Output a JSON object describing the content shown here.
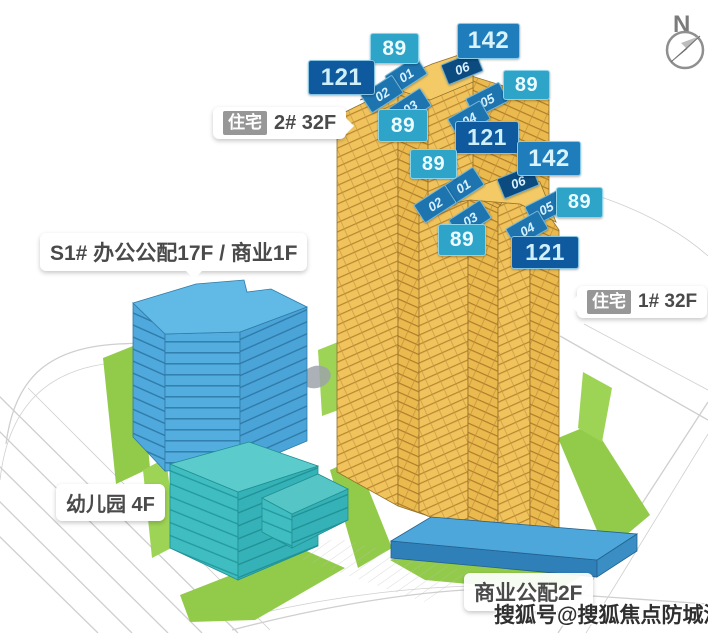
{
  "compass": {
    "label": "N"
  },
  "watermark": {
    "text": "搜狐号@搜狐焦点防城港站"
  },
  "callouts": {
    "residential_2": {
      "tag": "住宅",
      "label": "2# 32F"
    },
    "residential_1": {
      "tag": "住宅",
      "label": "1# 32F"
    },
    "office": {
      "label": "S1# 办公公配17F / 商业1F"
    },
    "kindergarten": {
      "label": "幼儿园 4F"
    },
    "commercial": {
      "label": "商业公配2F"
    }
  },
  "unit_badges": [
    {
      "value": "89",
      "variant": "light",
      "tower": "2#"
    },
    {
      "value": "142",
      "variant": "mid",
      "tower": "2#"
    },
    {
      "value": "121",
      "variant": "dark",
      "tower": "2#"
    },
    {
      "value": "89",
      "variant": "light",
      "tower": "2#"
    },
    {
      "value": "89",
      "variant": "light",
      "tower": "2#"
    },
    {
      "value": "121",
      "variant": "dark",
      "tower": "1#"
    },
    {
      "value": "142",
      "variant": "mid",
      "tower": "1#"
    },
    {
      "value": "89",
      "variant": "light",
      "tower": "1#"
    },
    {
      "value": "89",
      "variant": "light",
      "tower": "1#"
    },
    {
      "value": "89",
      "variant": "light",
      "tower": "1#"
    },
    {
      "value": "121",
      "variant": "dark",
      "tower": "1#"
    }
  ],
  "roof_units": [
    {
      "label": "01",
      "tower": "2#"
    },
    {
      "label": "02",
      "tower": "2#"
    },
    {
      "label": "03",
      "tower": "2#"
    },
    {
      "label": "06",
      "tower": "2#"
    },
    {
      "label": "05",
      "tower": "2#"
    },
    {
      "label": "04",
      "tower": "2#"
    },
    {
      "label": "01",
      "tower": "1#"
    },
    {
      "label": "02",
      "tower": "1#"
    },
    {
      "label": "03",
      "tower": "1#"
    },
    {
      "label": "06",
      "tower": "1#"
    },
    {
      "label": "05",
      "tower": "1#"
    },
    {
      "label": "04",
      "tower": "1#"
    }
  ],
  "colors": {
    "tower_gold": "#F1C35C",
    "tower_line": "#B8862E",
    "office_blue": "#4FA9DC",
    "kindergarten_teal": "#3FBDC0",
    "podium_blue": "#4EA7DB",
    "lawn_green": "#92CB4A",
    "badge_dark_blue": "#0F5A9E",
    "badge_mid_blue": "#1F7DBC",
    "badge_light_blue": "#2EA4C9",
    "roof_plate_blue": "#1E74AE",
    "roof_plate_navy": "#0C4B80"
  }
}
